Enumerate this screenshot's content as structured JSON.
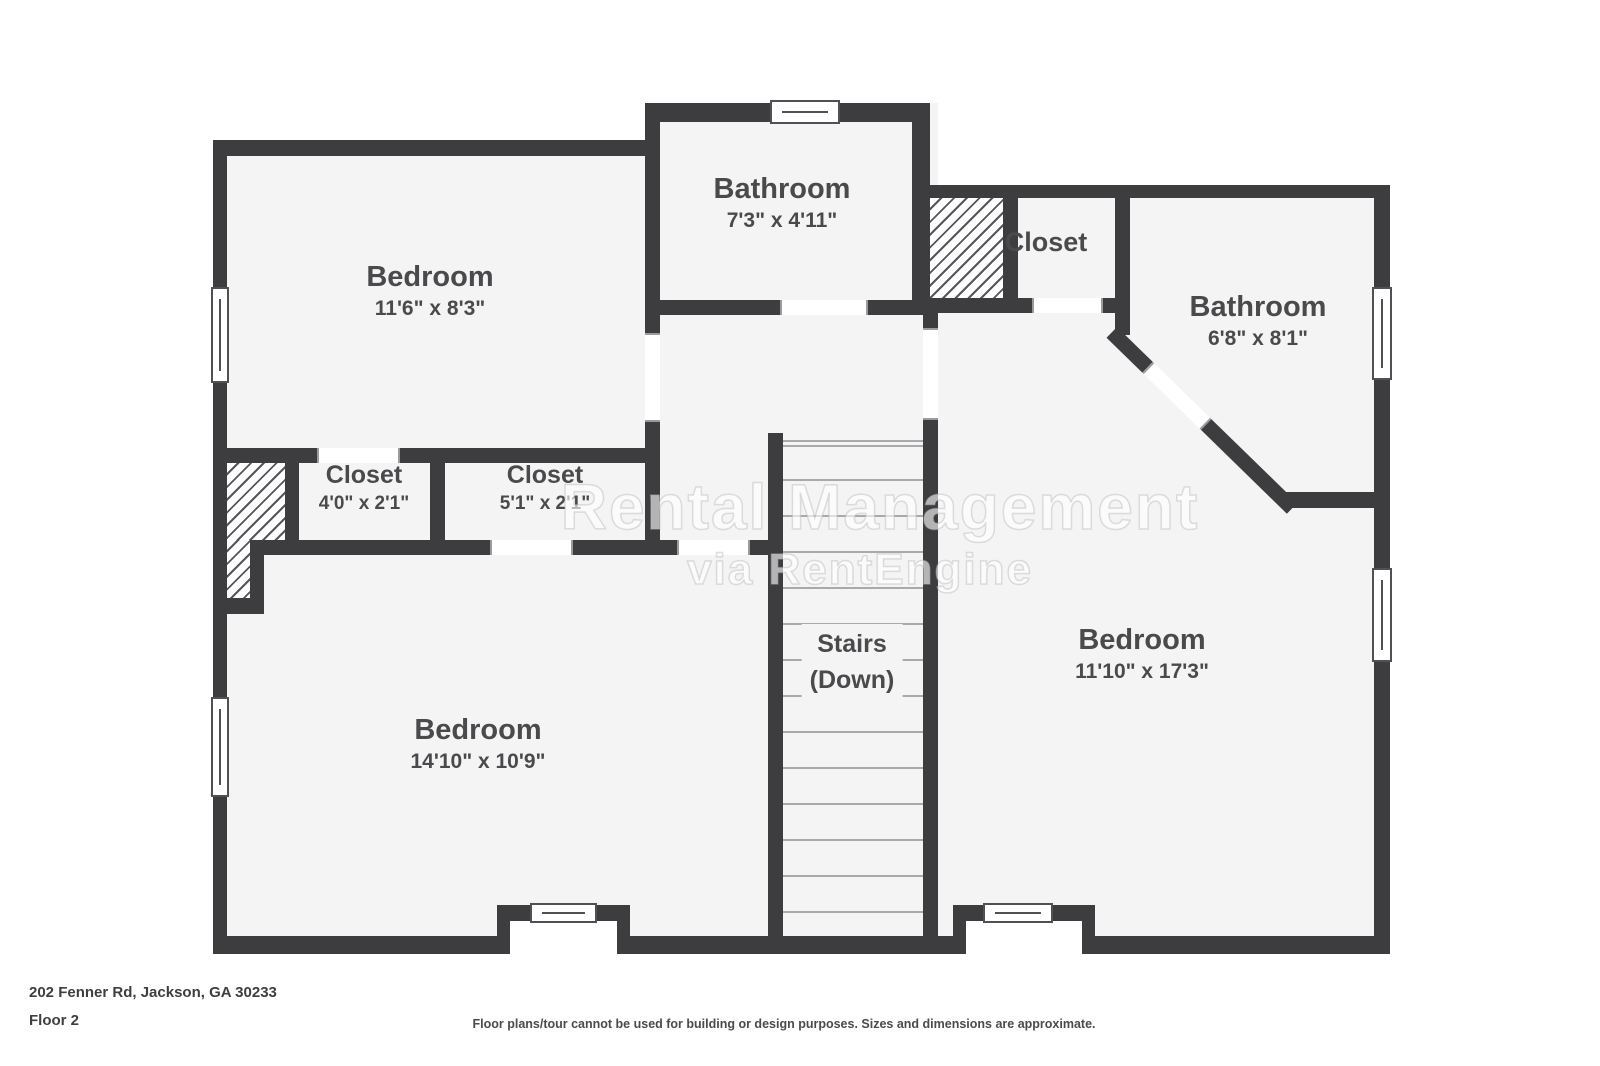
{
  "rooms": {
    "bedroom_tl": {
      "name": "Bedroom",
      "dims": "11'6\" x 8'3\""
    },
    "bathroom_top": {
      "name": "Bathroom",
      "dims": "7'3\" x 4'11\""
    },
    "closet_tr": {
      "name": "Closet"
    },
    "bathroom_tr": {
      "name": "Bathroom",
      "dims": "6'8\" x 8'1\""
    },
    "closet_left": {
      "name": "Closet",
      "dims": "4'0\" x 2'1\""
    },
    "closet_mid": {
      "name": "Closet",
      "dims": "5'1\" x 2'1\""
    },
    "stairs": {
      "line1": "Stairs",
      "line2": "(Down)"
    },
    "bedroom_bl": {
      "name": "Bedroom",
      "dims": "14'10\" x 10'9\""
    },
    "bedroom_r": {
      "name": "Bedroom",
      "dims": "11'10\" x 17'3\""
    }
  },
  "watermark": {
    "line1": "Rental Management",
    "line2": "via RentEngine"
  },
  "footer": {
    "address": "202 Fenner Rd, Jackson, GA 30233",
    "floor_label": "Floor 2",
    "disclaimer": "Floor plans/tour cannot be used for building or design purposes. Sizes and dimensions are approximate."
  },
  "colors": {
    "wall": "#3d3c3e",
    "floor": "#f4f4f5"
  }
}
